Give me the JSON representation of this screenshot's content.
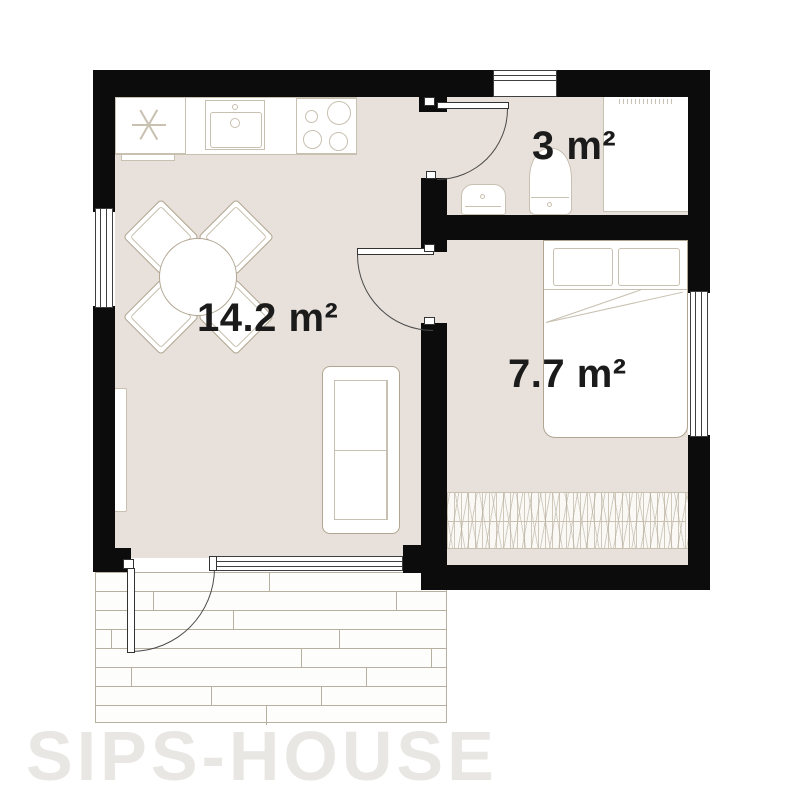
{
  "watermark": "SIPS-HOUSE",
  "rooms": [
    {
      "id": "living-kitchen",
      "area_label": "14.2 m²"
    },
    {
      "id": "bathroom",
      "area_label": "3 m²"
    },
    {
      "id": "bedroom",
      "area_label": "7.7 m²"
    }
  ],
  "icons": {
    "fridge": "snowflake",
    "stove": "four-burners",
    "kitchen_sink": "basin-with-faucet",
    "bathroom_sink": "washbasin",
    "toilet": "toilet-with-tank",
    "bed": "double-bed-two-pillows-folded-blanket",
    "sofa": "two-seat-sofa",
    "dining": "round-table-with-four-chairs",
    "rug": "stick-pattern-rug",
    "wardrobe": "cabinet-with-hatched-top",
    "radiator": "slim-wall-radiator",
    "deck": "wood-plank-terrace"
  },
  "colors": {
    "wall": "#0c0c0c",
    "floor": "#e8e1db",
    "line": "#b0a591",
    "line_light": "#c8c0b0",
    "deck_line": "#b7b0a0",
    "watermark": "#e9e7e3",
    "text": "#1b1b1b",
    "door_line": "#4a4a4a"
  }
}
